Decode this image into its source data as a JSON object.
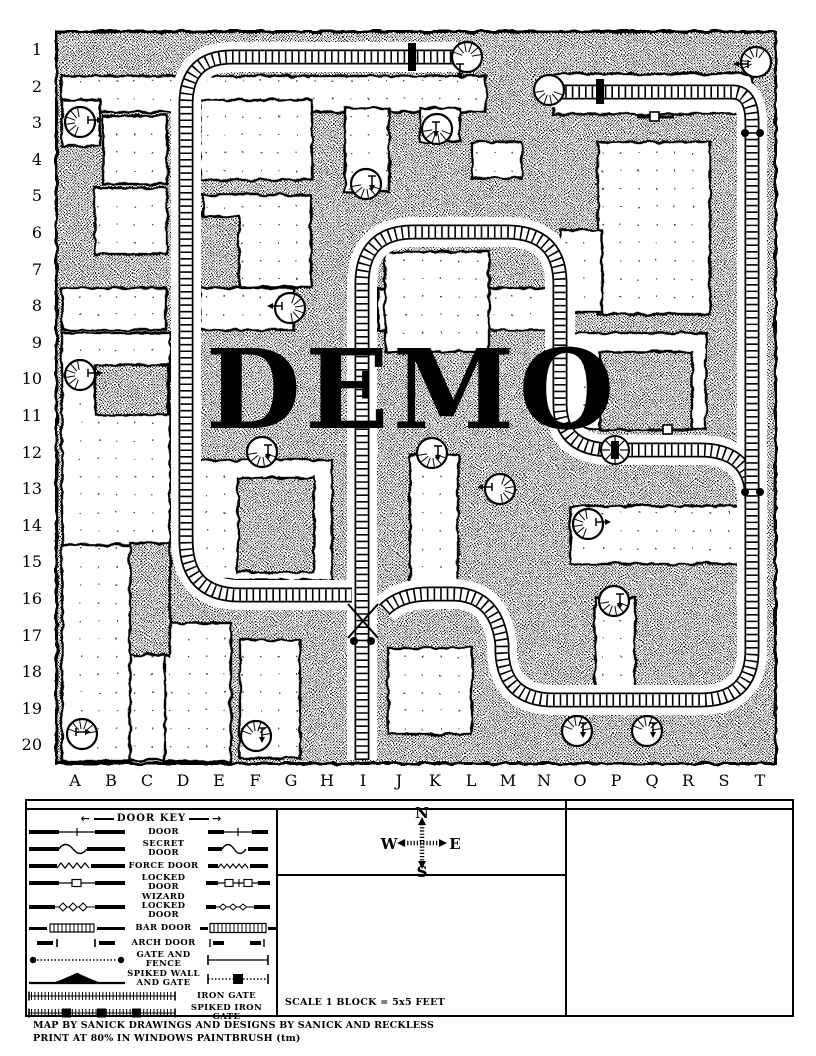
{
  "map": {
    "watermark": "DEMO",
    "row_labels": [
      "1",
      "2",
      "3",
      "4",
      "5",
      "6",
      "7",
      "8",
      "9",
      "10",
      "11",
      "12",
      "13",
      "14",
      "15",
      "16",
      "17",
      "18",
      "19",
      "20"
    ],
    "col_labels": [
      "A",
      "B",
      "C",
      "D",
      "E",
      "F",
      "G",
      "H",
      "I",
      "J",
      "K",
      "L",
      "M",
      "N",
      "O",
      "P",
      "Q",
      "R",
      "S",
      "T"
    ]
  },
  "legend": {
    "title": "DOOR KEY",
    "items": [
      {
        "label": "DOOR"
      },
      {
        "label": "SECRET DOOR"
      },
      {
        "label": "FORCE DOOR"
      },
      {
        "label": "LOCKED DOOR"
      },
      {
        "label": "WIZARD LOCKED DOOR"
      },
      {
        "label": "BAR DOOR"
      },
      {
        "label": "ARCH DOOR"
      },
      {
        "label": "GATE AND FENCE"
      },
      {
        "label": "SPIKED WALL AND GATE"
      },
      {
        "label": "IRON GATE"
      },
      {
        "label": "SPIKED IRON GATE"
      }
    ]
  },
  "compass": {
    "north": "N",
    "south": "S",
    "east": "E",
    "west": "W"
  },
  "scale_note": "SCALE 1 BLOCK = 5x5 FEET",
  "credits": {
    "line1": "MAP BY SANICK  DRAWINGS AND DESIGNS BY SANICK AND RECKLESS",
    "line2": "PRINT AT 80% IN WINDOWS PAINTBRUSH (tm)"
  }
}
